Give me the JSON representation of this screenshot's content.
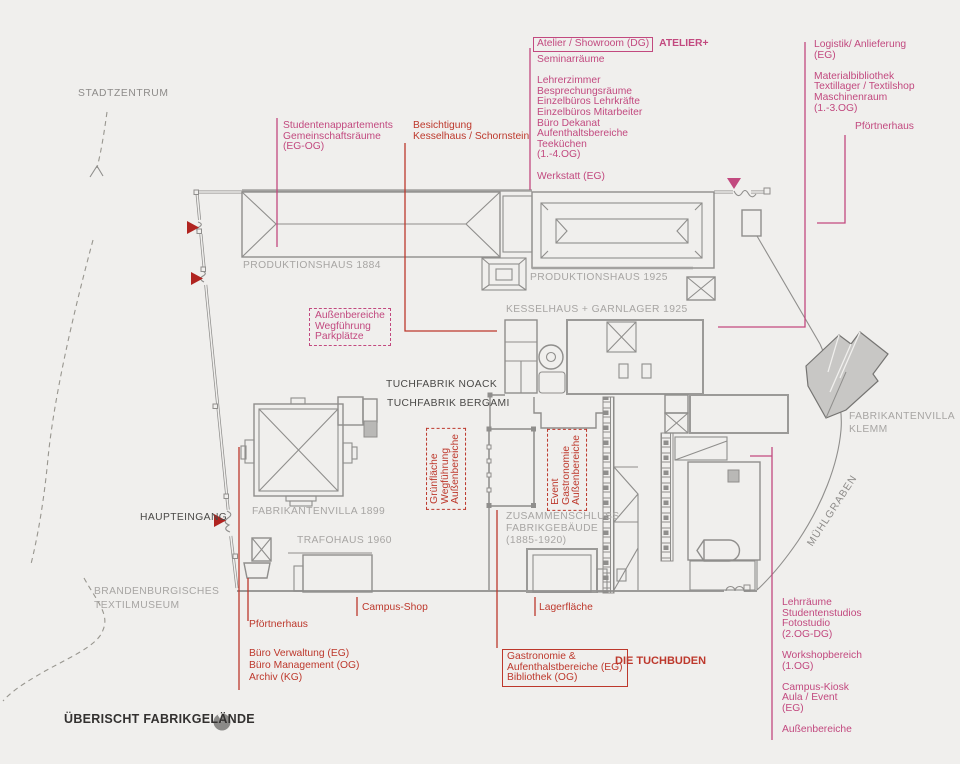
{
  "colors": {
    "background": "#f0efed",
    "plan_line_gray": "#8f8e8c",
    "building_label_gray": "#a7a5a3",
    "dark_label": "#4a4947",
    "accent_pink": "#c2497f",
    "accent_red": "#bd382c",
    "marker_red": "#b02420",
    "klemm_fill": "#c8c7c5"
  },
  "title": {
    "text": "ÜBERISCHT FABRIKGELÄNDE"
  },
  "context": {
    "stadtzentrum": "STADTZENTRUM",
    "haupteingang": "HAUPTEINGANG",
    "muehlgraben": "MÜHLGRABEN",
    "textilmuseum": "BRANDENBURGISCHES\nTEXTILMUSEUM"
  },
  "buildings": {
    "produktionshaus_1884": "PRODUKTIONSHAUS 1884",
    "produktionshaus_1925": "PRODUKTIONSHAUS 1925",
    "kesselhaus_garnlager": "KESSELHAUS + GARNLAGER 1925",
    "tuchfabrik_noack": "TUCHFABRIK NOACK",
    "tuchfabrik_bergami": "TUCHFABRIK BERGAMI",
    "fabrikantenvilla_1899": "FABRIKANTENVILLA 1899",
    "trafohaus_1960": "TRAFOHAUS 1960",
    "zusammenschluss": "ZUSAMMENSCHLUSS\nFABRIKGEBÄUDE\n(1885-1920)",
    "fabrikantenvilla_klemm": "FABRIKANTENVILLA\nKLEMM"
  },
  "program_north": {
    "studentenappartements": "Studentenappartements\nGemeinschaftsräume\n(EG-OG)",
    "besichtigung": "Besichtigung\nKesselhaus / Schornstein",
    "atelier_boxed": "Atelier / Showroom (DG)",
    "atelier_brand": "ATELIER+",
    "atelier_program": "Seminarräume\n\nLehrerzimmer\nBesprechungsräume\nEinzelbüros Lehrkräfte\nEinzelbüros Mitarbeiter\nBüro Dekanat\nAufenthaltsbereiche\nTeeküchen\n(1.-4.OG)\n\nWerkstatt (EG)",
    "logistik": "Logistik/ Anlieferung\n(EG)\n\nMaterialbibliothek\nTextillager / Textilshop\nMaschinenraum\n(1.-3.OG)",
    "pfoertnerhaus": "Pförtnerhaus"
  },
  "outdoor": {
    "parkplaetze": "Außenbereiche\nWegführung\nParkplätze",
    "gruenflaeche": {
      "lines": [
        "Außenbereiche",
        "Wegführung",
        "Grünfläche"
      ]
    },
    "gastronomie_event": {
      "lines": [
        "Außenbereiche",
        "Gastronomie",
        "Event"
      ]
    }
  },
  "program_south": {
    "pfoertnerhaus": "Pförtnerhaus",
    "verwaltung": "Büro Verwaltung (EG)\nBüro Management (OG)\nArchiv (KG)",
    "campus_shop": "Campus-Shop",
    "lagerflaeche": "Lagerfläche",
    "tuchbuden_box": "Gastronomie &\nAufenthalstbereiche (EG)\nBibliothek (OG)",
    "tuchbuden_name": "DIE TUCHBUDEN",
    "ost": "Lehrräume\nStudentenstudios\nFotostudio\n(2.OG-DG)\n\nWorkshopbereich\n(1.OG)\n\nCampus-Kiosk\nAula / Event\n(EG)\n\nAußenbereiche"
  }
}
